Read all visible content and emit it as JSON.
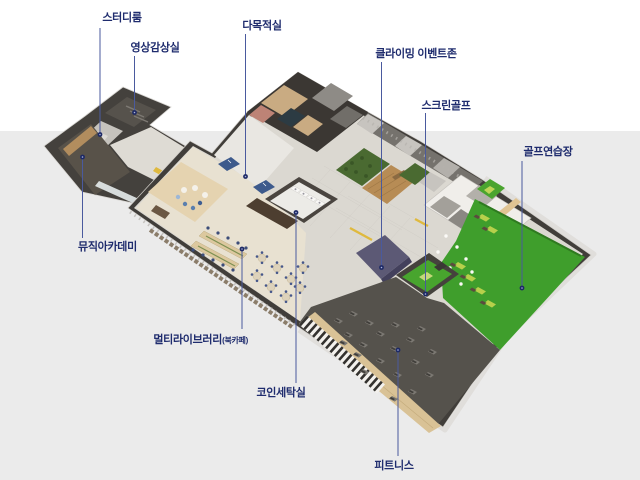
{
  "image": {
    "kind": "isometric-floorplan-infographic",
    "background_top_color": "#ffffff",
    "background_bottom_color": "#ebebeb"
  },
  "palette": {
    "label_text": "#1f2c6e",
    "leader_line": "#4a5a9e",
    "callout_dot": "#1d2965",
    "dark_wall": "#413e3a",
    "tile_floor": "#dbd8d1",
    "library_wood_floor": "#e8e1d1",
    "turf_green": "#3f9e2c",
    "fitness_floor": "#55524c",
    "climbing_purple": "#5c5975",
    "deck_wood": "#b78c55"
  },
  "callouts": [
    {
      "id": "study-room",
      "label": "스터디룸"
    },
    {
      "id": "video-room",
      "label": "영상감상실"
    },
    {
      "id": "multipurpose-room",
      "label": "다목적실"
    },
    {
      "id": "climbing-event-zone",
      "label": "클라이밍 이벤트존"
    },
    {
      "id": "screen-golf",
      "label": "스크린골프"
    },
    {
      "id": "golf-practice-range",
      "label": "골프연습장"
    },
    {
      "id": "music-academy",
      "label": "뮤직아카데미"
    },
    {
      "id": "multi-library",
      "label": "멀티라이브러리",
      "label_suffix": "(북카페)"
    },
    {
      "id": "coin-laundry",
      "label": "코인세탁실"
    },
    {
      "id": "fitness",
      "label": "피트니스"
    }
  ]
}
